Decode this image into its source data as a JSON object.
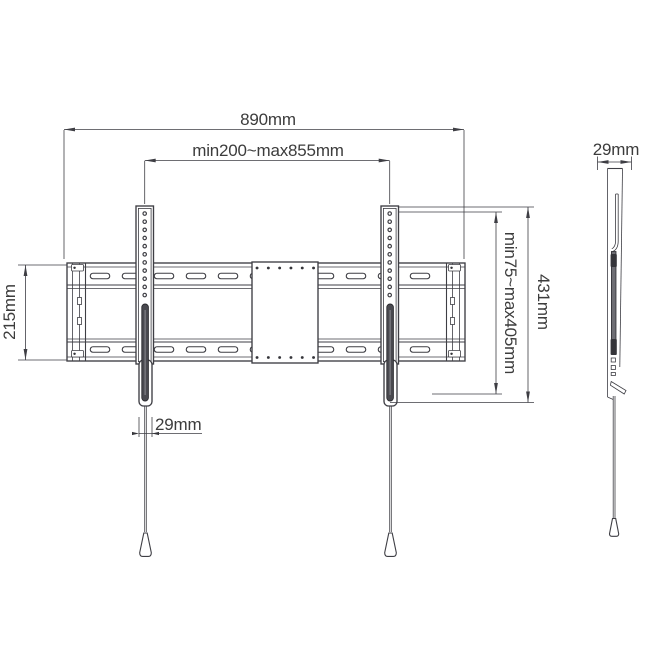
{
  "front": {
    "dims": {
      "overall_width": "890mm",
      "vesa_width": "min200~max855mm",
      "plate_height": "215mm",
      "vesa_height": "min75~max405mm",
      "arm_height": "431mm",
      "arm_width": "29mm"
    }
  },
  "side": {
    "dims": {
      "depth": "29mm"
    }
  },
  "colors": {
    "background": "#ffffff",
    "line": "#3e3e44",
    "text": "#3c3c3c",
    "arm_slot_fill": "#4a4a50",
    "latch_fill": "#6e6e74"
  }
}
